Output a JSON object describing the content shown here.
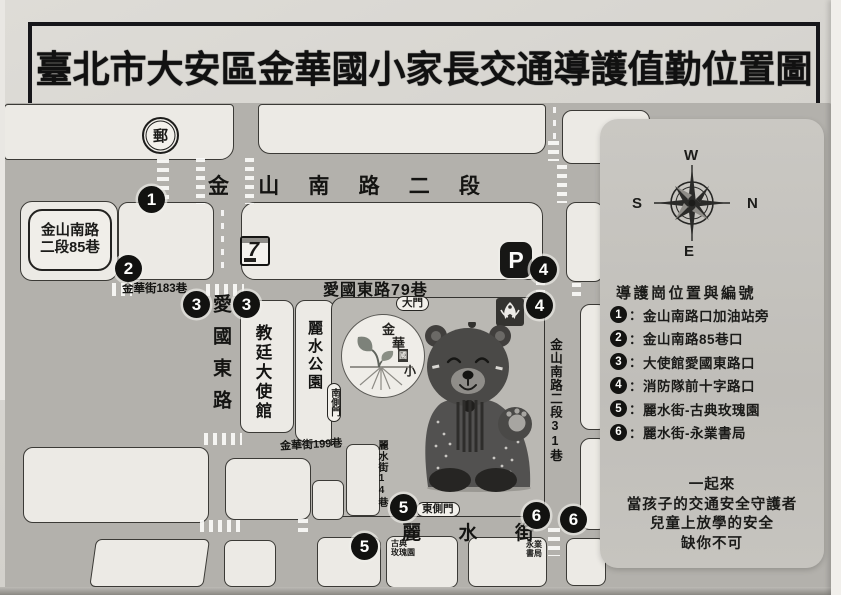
{
  "title": {
    "text": "臺北市大安區金華國小家長交通導護值勤位置圖"
  },
  "map": {
    "road_jinshan": {
      "chars": [
        "金",
        "山",
        "南",
        "路",
        "二",
        "段"
      ]
    },
    "road_aiguo79": "愛國東路79巷",
    "road_jinhua183": "金華街183巷",
    "road_jinhua199": "金華街199巷",
    "road_aiguo_east": "愛國東路",
    "road_lishui": {
      "chars": [
        "麗",
        "水",
        "街"
      ]
    },
    "road_lishui14": "麗水街14巷",
    "road_jinshan31": "金山南路二段31巷",
    "lane85_box": {
      "line1": "金山南路",
      "line2": "二段85巷"
    },
    "embassy": "教廷大使館",
    "park": "麗水公園",
    "rose_garden": {
      "line1": "古典",
      "line2": "玫瑰園"
    },
    "bookstore": {
      "line1": "永業",
      "line2": "書局"
    },
    "gates": {
      "main": "大門",
      "south": "南側門",
      "east": "東側門"
    },
    "school_logo": {
      "chars": [
        "金",
        "華",
        "國",
        "小"
      ]
    },
    "icons": {
      "post": "郵",
      "seven": "7",
      "parking": "P"
    },
    "markers": [
      "1",
      "2",
      "3",
      "3",
      "4",
      "4",
      "5",
      "5",
      "6",
      "6"
    ]
  },
  "legend": {
    "compass": {
      "w": "W",
      "n": "N",
      "s": "S",
      "e": "E"
    },
    "title": "導護崗位置與編號",
    "colon": "：",
    "items": [
      {
        "num": "1",
        "label": "金山南路口加油站旁"
      },
      {
        "num": "2",
        "label": "金山南路85巷口"
      },
      {
        "num": "3",
        "label": "大使館愛國東路口"
      },
      {
        "num": "4",
        "label": "消防隊前十字路口"
      },
      {
        "num": "5",
        "label": "麗水街-古典玫瑰園"
      },
      {
        "num": "6",
        "label": "麗水街-永業書局"
      }
    ],
    "slogan": [
      "一起來",
      "當孩子的交通安全守護者",
      "兒童上放學的安全",
      "缺你不可"
    ]
  }
}
